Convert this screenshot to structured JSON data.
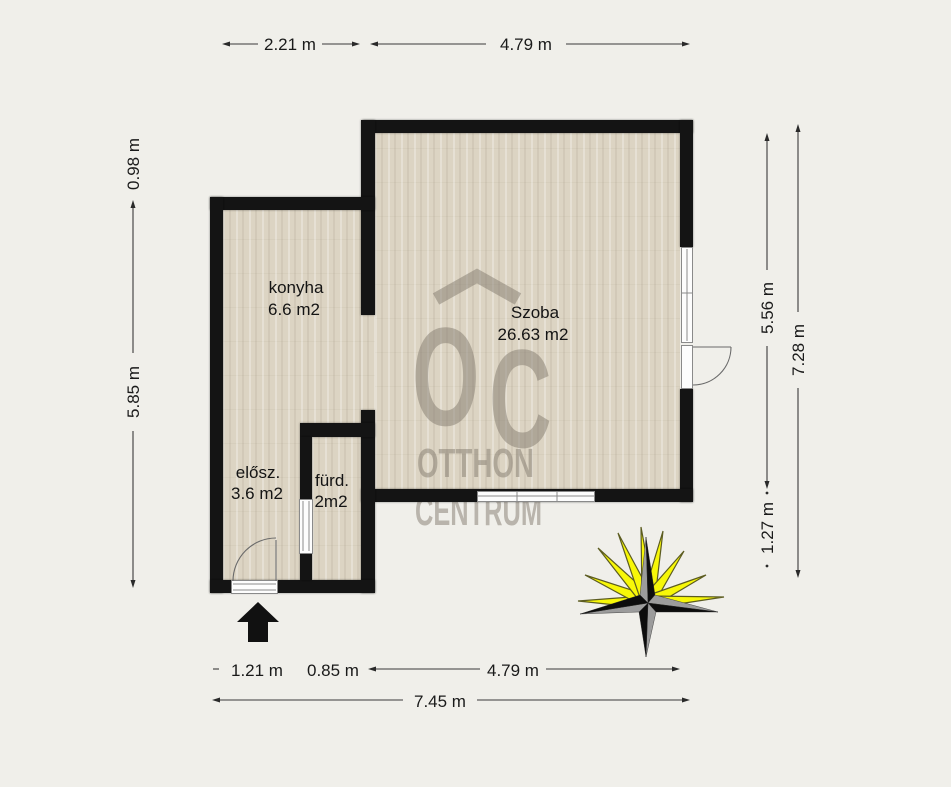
{
  "dimensions": {
    "top": [
      "2.21 m",
      "4.79 m"
    ],
    "left": [
      "0.98 m",
      "5.85 m"
    ],
    "right": [
      "5.56 m",
      "7.28 m",
      "1.27 m"
    ],
    "bottom_row1": [
      "1.21 m",
      "0.85 m",
      "4.79 m"
    ],
    "bottom_row2": [
      "7.45 m"
    ]
  },
  "rooms": [
    {
      "name": "konyha",
      "area": "6.6 m2"
    },
    {
      "name": "Szoba",
      "area": "26.63 m2"
    },
    {
      "name": "elősz.",
      "area": "3.6 m2"
    },
    {
      "name": "fürd.",
      "area": "2m2"
    }
  ],
  "watermark": {
    "monogram_o": "O",
    "monogram_c": "C",
    "line1": "OTTHON",
    "line2": "CENTRUM"
  },
  "colors": {
    "wall": "#141414",
    "floor": "#dcd4c3",
    "background": "#f0efea",
    "ray_yellow": "#f7f708",
    "star_black": "#0d0d0d",
    "star_gray": "#9c9c9c",
    "watermark_gray": "#837b6f"
  }
}
